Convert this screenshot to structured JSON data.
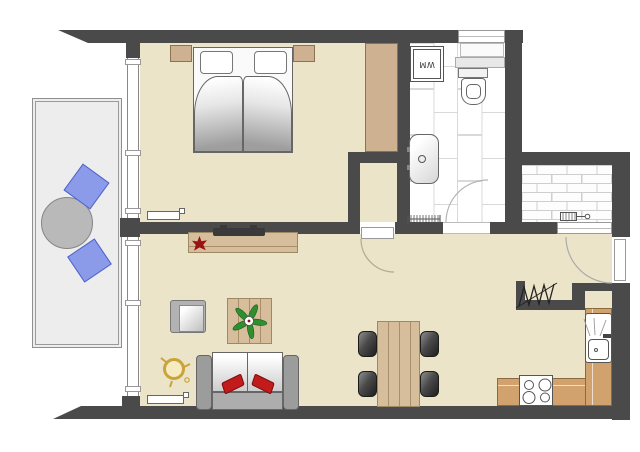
{
  "labels": {
    "washing_machine": "WM"
  },
  "colors": {
    "wall": "#4a4a4a",
    "floor_beige": "#ebe4c8",
    "balcony_floor": "#ededed",
    "bathroom_tile_joint": "#d9d9d9",
    "porch_brick_joint": "#cfcfcf",
    "wood_light": "#d6bd9b",
    "cabinet_tan": "#cdb190",
    "kitchen_counter": "#d1a26e",
    "balcony_chair_blue": "#8b9bea",
    "sofa_pillow_red": "#c21b1b",
    "plant_green": "#2f8f2f",
    "plant_red": "#9c1212",
    "lamp_gold": "#c9a43b",
    "dark_furniture": "#3f3f3f"
  },
  "rooms": {
    "bedroom": {
      "furniture": [
        "double-bed",
        "two-pillows",
        "two-nightstands",
        "wardrobe",
        "radiator"
      ]
    },
    "bathroom": {
      "furniture": [
        "washing-machine",
        "window",
        "shelf",
        "toilet",
        "washbasin",
        "radiator",
        "door"
      ]
    },
    "closet": {
      "furniture": [
        "door"
      ]
    },
    "living_room": {
      "furniture": [
        "sideboard",
        "tv",
        "red-plant",
        "armchair",
        "coffee-table",
        "green-plant",
        "floor-lamp",
        "sofa",
        "two-red-cushions",
        "radiator"
      ]
    },
    "dining_area": {
      "furniture": [
        "dining-table",
        "four-chairs"
      ]
    },
    "kitchen": {
      "furniture": [
        "l-shaped-counter",
        "stove",
        "sink-unit",
        "coat-rack",
        "alcove"
      ]
    },
    "balcony": {
      "furniture": [
        "round-table",
        "two-blue-chairs",
        "railing"
      ]
    },
    "entrance": {
      "furniture": [
        "entrance-door",
        "brick-porch",
        "doormat-symbol",
        "window"
      ]
    }
  }
}
